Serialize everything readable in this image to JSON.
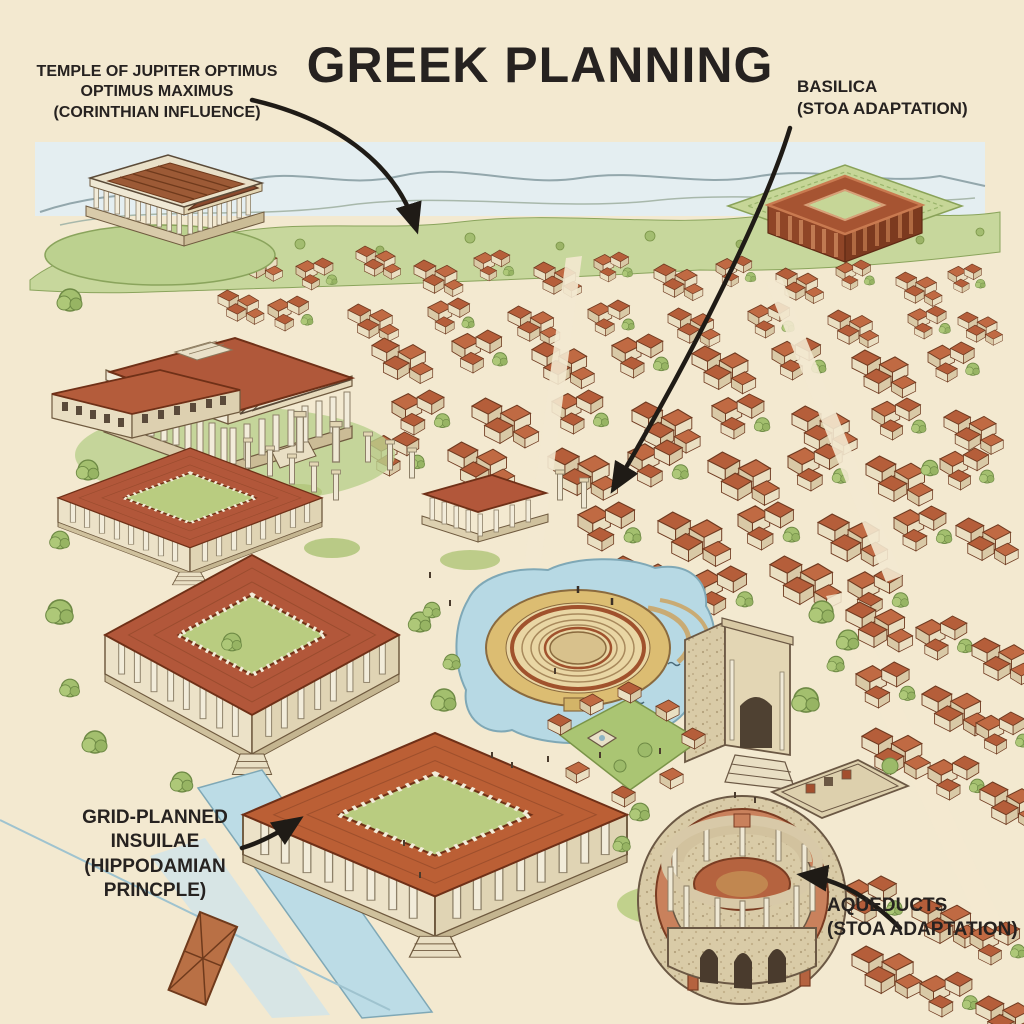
{
  "title": "GREEK PLANNING",
  "annotations": {
    "temple": {
      "lines": [
        "TEMPLE OF JUPITER OPTIMUS",
        "OPTIMUS MAXIMUS",
        "(CORINTHIAN INFLUENCE)"
      ]
    },
    "basilica": {
      "lines": [
        "BASILICA",
        "(STOA ADAPTATION)"
      ]
    },
    "insulae": {
      "lines": [
        "GRID-PLANNED",
        "INSUILAE",
        "(HIPPODAMIAN",
        "PRINCPLE)"
      ]
    },
    "aqueducts": {
      "lines": [
        "AQUEDUCTS",
        "(STOA ADAPTATION)"
      ]
    }
  },
  "colors": {
    "background": "#f3e9d0",
    "ink": "#262220",
    "roof_terracotta": "#b2573a",
    "water": "#b7d9e4",
    "grass": "#aec87a",
    "hills": "#c7d79c",
    "sky": "#e4eef1",
    "stone": "#d9cba7"
  }
}
